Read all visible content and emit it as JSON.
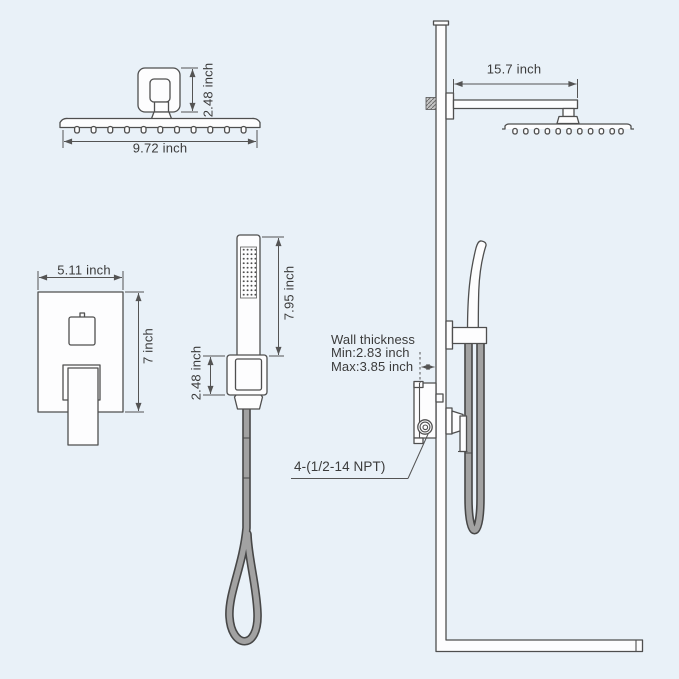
{
  "title": "Shower system dimension diagram",
  "colors": {
    "background": "#e9f1f8",
    "line": "#4f4f4f",
    "dim": "#545454",
    "text": "#3b3b3b",
    "fill": "#fdfdfe",
    "hose": "#a2a2a2"
  },
  "annotations": {
    "overhead_shower": {
      "width": "9.72 inch",
      "mount_height": "2.48 inch"
    },
    "shower_arm": {
      "length": "15.7 inch"
    },
    "valve_trim": {
      "width": "5.11 inch",
      "height": "7 inch"
    },
    "hand_shower": {
      "height": "7.95 inch",
      "bracket_height": "2.48 inch"
    },
    "wall_thickness": {
      "title": "Wall thickness",
      "min": "Min:2.83 inch",
      "max": "Max:3.85 inch"
    },
    "thread_note": "4-(1/2-14 NPT)"
  }
}
